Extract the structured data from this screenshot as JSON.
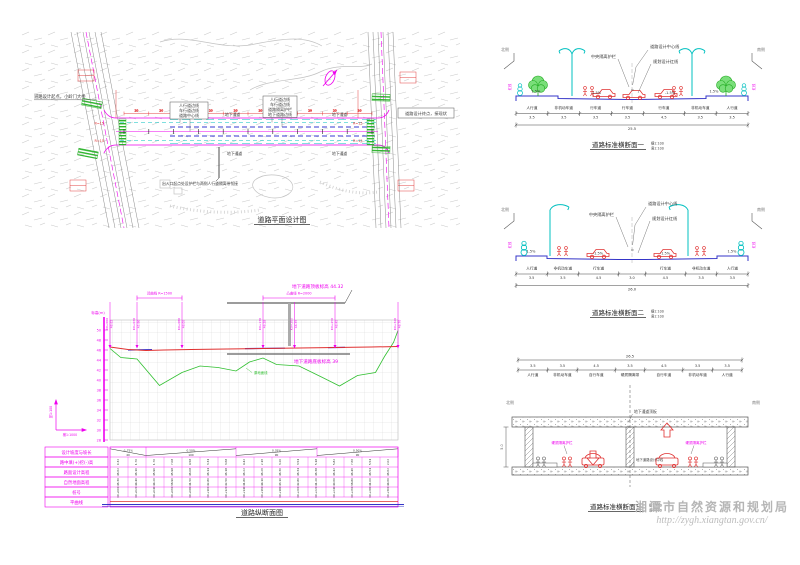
{
  "colors": {
    "magenta": "#ee00ee",
    "cyan": "#00c0c0",
    "red": "#e03030",
    "green": "#2fbf2f",
    "blue": "#3a3ad0",
    "ink": "#3a3a3a",
    "hatch": "#c4c4c4",
    "watermark": "#b5b5b5"
  },
  "watermark": {
    "agency": "湘潭市自然资源和规划局",
    "url": "http://zygh.xiangtan.gov.cn/"
  },
  "plan": {
    "title": "道路平面设计图",
    "start_label": "道路设计起点，小岭门大桥",
    "end_label": "道路设计终点，接现状",
    "note": "出入口起点处设护栏与两侧人行道隔离带衔接",
    "underpass_label": "地下通道",
    "legend_left": [
      "人行道边线",
      "车行道边线",
      "道路中心线"
    ],
    "legend_right": [
      "人行道边线",
      "车行道边线",
      "道路隔离护栏",
      "地下道路边线"
    ],
    "radius_label": "R=15",
    "station_interval": "20"
  },
  "profile": {
    "title": "道路纵断面图",
    "axis_label": "标高(m)",
    "scale_v": "竖1:100",
    "scale_h": "横1:1000",
    "top_slab_label": "地下道路顶板标高 44.32",
    "bottom_slab_label": "地下道路底板标高 39",
    "ground_line_label": "原地面线",
    "elev_ticks": [
      50,
      48,
      46,
      44,
      42,
      40,
      38,
      36,
      34,
      32,
      30,
      28
    ],
    "flags": [
      {
        "m": 0,
        "sta": "K0+000",
        "elev": "46.62"
      },
      {
        "m": 30,
        "sta": "K0+030",
        "elev": "45.90"
      },
      {
        "m": 80,
        "sta": "K0+080",
        "elev": "46.05"
      },
      {
        "m": 170,
        "sta": "K0+170",
        "elev": "46.28"
      },
      {
        "m": 205,
        "sta": "K0+205",
        "elev": "46.35"
      },
      {
        "m": 250,
        "sta": "K0+250",
        "elev": "46.45"
      },
      {
        "m": 320,
        "sta": "K0+320",
        "elev": "46.70"
      }
    ],
    "curves": [
      {
        "label": "凹曲线 R=1500",
        "m0": 30,
        "m1": 80
      },
      {
        "label": "凸曲线 R=2000",
        "m0": 170,
        "m1": 250
      }
    ],
    "slope_segments": [
      {
        "label": "-1.75%",
        "len": "40",
        "m0": 0,
        "m1": 40,
        "dir": -1
      },
      {
        "label": "0.50%",
        "len": "100",
        "m0": 40,
        "m1": 140,
        "dir": 1
      },
      {
        "label": "0.35%",
        "len": "90",
        "m0": 140,
        "m1": 230,
        "dir": 1
      },
      {
        "label": "0.50%",
        "len": "90",
        "m0": 230,
        "m1": 320,
        "dir": 1
      }
    ],
    "design_line": [
      [
        0,
        46.6
      ],
      [
        20,
        46.1
      ],
      [
        40,
        45.9
      ],
      [
        60,
        46.0
      ],
      [
        90,
        46.1
      ],
      [
        130,
        46.2
      ],
      [
        170,
        46.3
      ],
      [
        210,
        46.4
      ],
      [
        250,
        46.5
      ],
      [
        290,
        46.6
      ],
      [
        320,
        46.7
      ]
    ],
    "ground_line": [
      [
        0,
        46.3
      ],
      [
        12,
        44.5
      ],
      [
        30,
        44.2
      ],
      [
        55,
        38.9
      ],
      [
        80,
        41.5
      ],
      [
        100,
        42.8
      ],
      [
        120,
        42.5
      ],
      [
        140,
        41.8
      ],
      [
        155,
        43.6
      ],
      [
        170,
        44.4
      ],
      [
        185,
        43.1
      ],
      [
        210,
        42.8
      ],
      [
        235,
        40.6
      ],
      [
        255,
        38.8
      ],
      [
        275,
        40.9
      ],
      [
        295,
        41.5
      ],
      [
        305,
        44.7
      ],
      [
        315,
        47.5
      ],
      [
        320,
        49.9
      ]
    ],
    "table_rows": [
      "设计坡度与坡长",
      "路中填(+)挖(-)高",
      "路面设计高程",
      "自然地面高程",
      "桩号",
      "平曲线"
    ],
    "stations": [
      "K0+000",
      "K0+020",
      "K0+040",
      "K0+060",
      "K0+080",
      "K0+100",
      "K0+120",
      "K0+140",
      "K0+160",
      "K0+180",
      "K0+200",
      "K0+220",
      "K0+240",
      "K0+260",
      "K0+280",
      "K0+300"
    ],
    "design_elev": [
      "46.62",
      "46.10",
      "45.90",
      "45.98",
      "46.08",
      "46.14",
      "46.18",
      "46.22",
      "46.26",
      "46.30",
      "46.34",
      "46.38",
      "46.42",
      "46.46",
      "46.54",
      "46.62"
    ],
    "ground_elev": [
      "46.30",
      "44.40",
      "44.20",
      "38.90",
      "41.50",
      "42.80",
      "42.50",
      "41.80",
      "44.10",
      "43.10",
      "42.80",
      "41.20",
      "40.60",
      "38.80",
      "41.00",
      "44.60"
    ],
    "cut_fill": [
      "0.32",
      "1.70",
      "1.70",
      "7.08",
      "4.58",
      "3.34",
      "3.68",
      "4.42",
      "2.16",
      "3.20",
      "3.54",
      "5.18",
      "5.82",
      "7.66",
      "5.54",
      "2.02"
    ]
  },
  "sections": [
    {
      "title": "道路标准横断面一",
      "scale_h": "横1:100",
      "scale_v": "竖1:100",
      "side_left": "北侧",
      "side_right": "南侧",
      "redline_side": "红线",
      "labels": {
        "centerline": "道路设计中心线",
        "barrier": "中央隔离护栏",
        "redline": "规划设计红线"
      },
      "slope_walk": "1.5%",
      "slope_road": "-1.5%",
      "lanes": [
        {
          "name": "人行道",
          "w": 3.5
        },
        {
          "name": "非机动车道",
          "w": 3.5
        },
        {
          "name": "行车道",
          "w": 3.5
        },
        {
          "name": "行车道",
          "w": 3.5
        },
        {
          "name": "行车道",
          "w": 4.5
        },
        {
          "name": "非机动车道",
          "w": 3.5
        },
        {
          "name": "人行道",
          "w": 3.5
        }
      ],
      "total": "25.5"
    },
    {
      "title": "道路标准横断面二",
      "scale_h": "横1:100",
      "scale_v": "竖1:100",
      "side_left": "北侧",
      "side_right": "南侧",
      "redline_side": "红线",
      "labels": {
        "centerline": "道路设计中心线",
        "barrier": "中央隔离护栏",
        "redline": "规划设计红线"
      },
      "slope_walk": "1.5%",
      "slope_road": "-1.5%",
      "lanes": [
        {
          "name": "人行道",
          "w": 3.5
        },
        {
          "name": "非机动车道",
          "w": 3.5
        },
        {
          "name": "行车道",
          "w": 4.5
        },
        {
          "name": "",
          "w": 3.0
        },
        {
          "name": "行车道",
          "w": 4.5
        },
        {
          "name": "非机动车道",
          "w": 3.5
        },
        {
          "name": "人行道",
          "w": 3.5
        }
      ],
      "total": "26.0"
    },
    {
      "title": "道路标准横断面三",
      "scale_h": "横1:100",
      "scale_v": "竖1:100",
      "side_left": "北侧",
      "side_right": "南侧",
      "labels": {
        "top_slab": "地下通道顶板",
        "barrier": "硬质隔离护栏",
        "centerline": "地下道路设计中线",
        "depth": "5.0"
      },
      "lanes": [
        {
          "name": "人行道",
          "w": 3.5
        },
        {
          "name": "非机动车道",
          "w": 3.5
        },
        {
          "name": "自行车道",
          "w": 4.5
        },
        {
          "name": "硬质隔离带",
          "w": 3.5
        },
        {
          "name": "自行车道",
          "w": 4.5
        },
        {
          "name": "非机动车道",
          "w": 3.5
        },
        {
          "name": "人行道",
          "w": 3.5
        }
      ],
      "total": "26.5"
    }
  ]
}
